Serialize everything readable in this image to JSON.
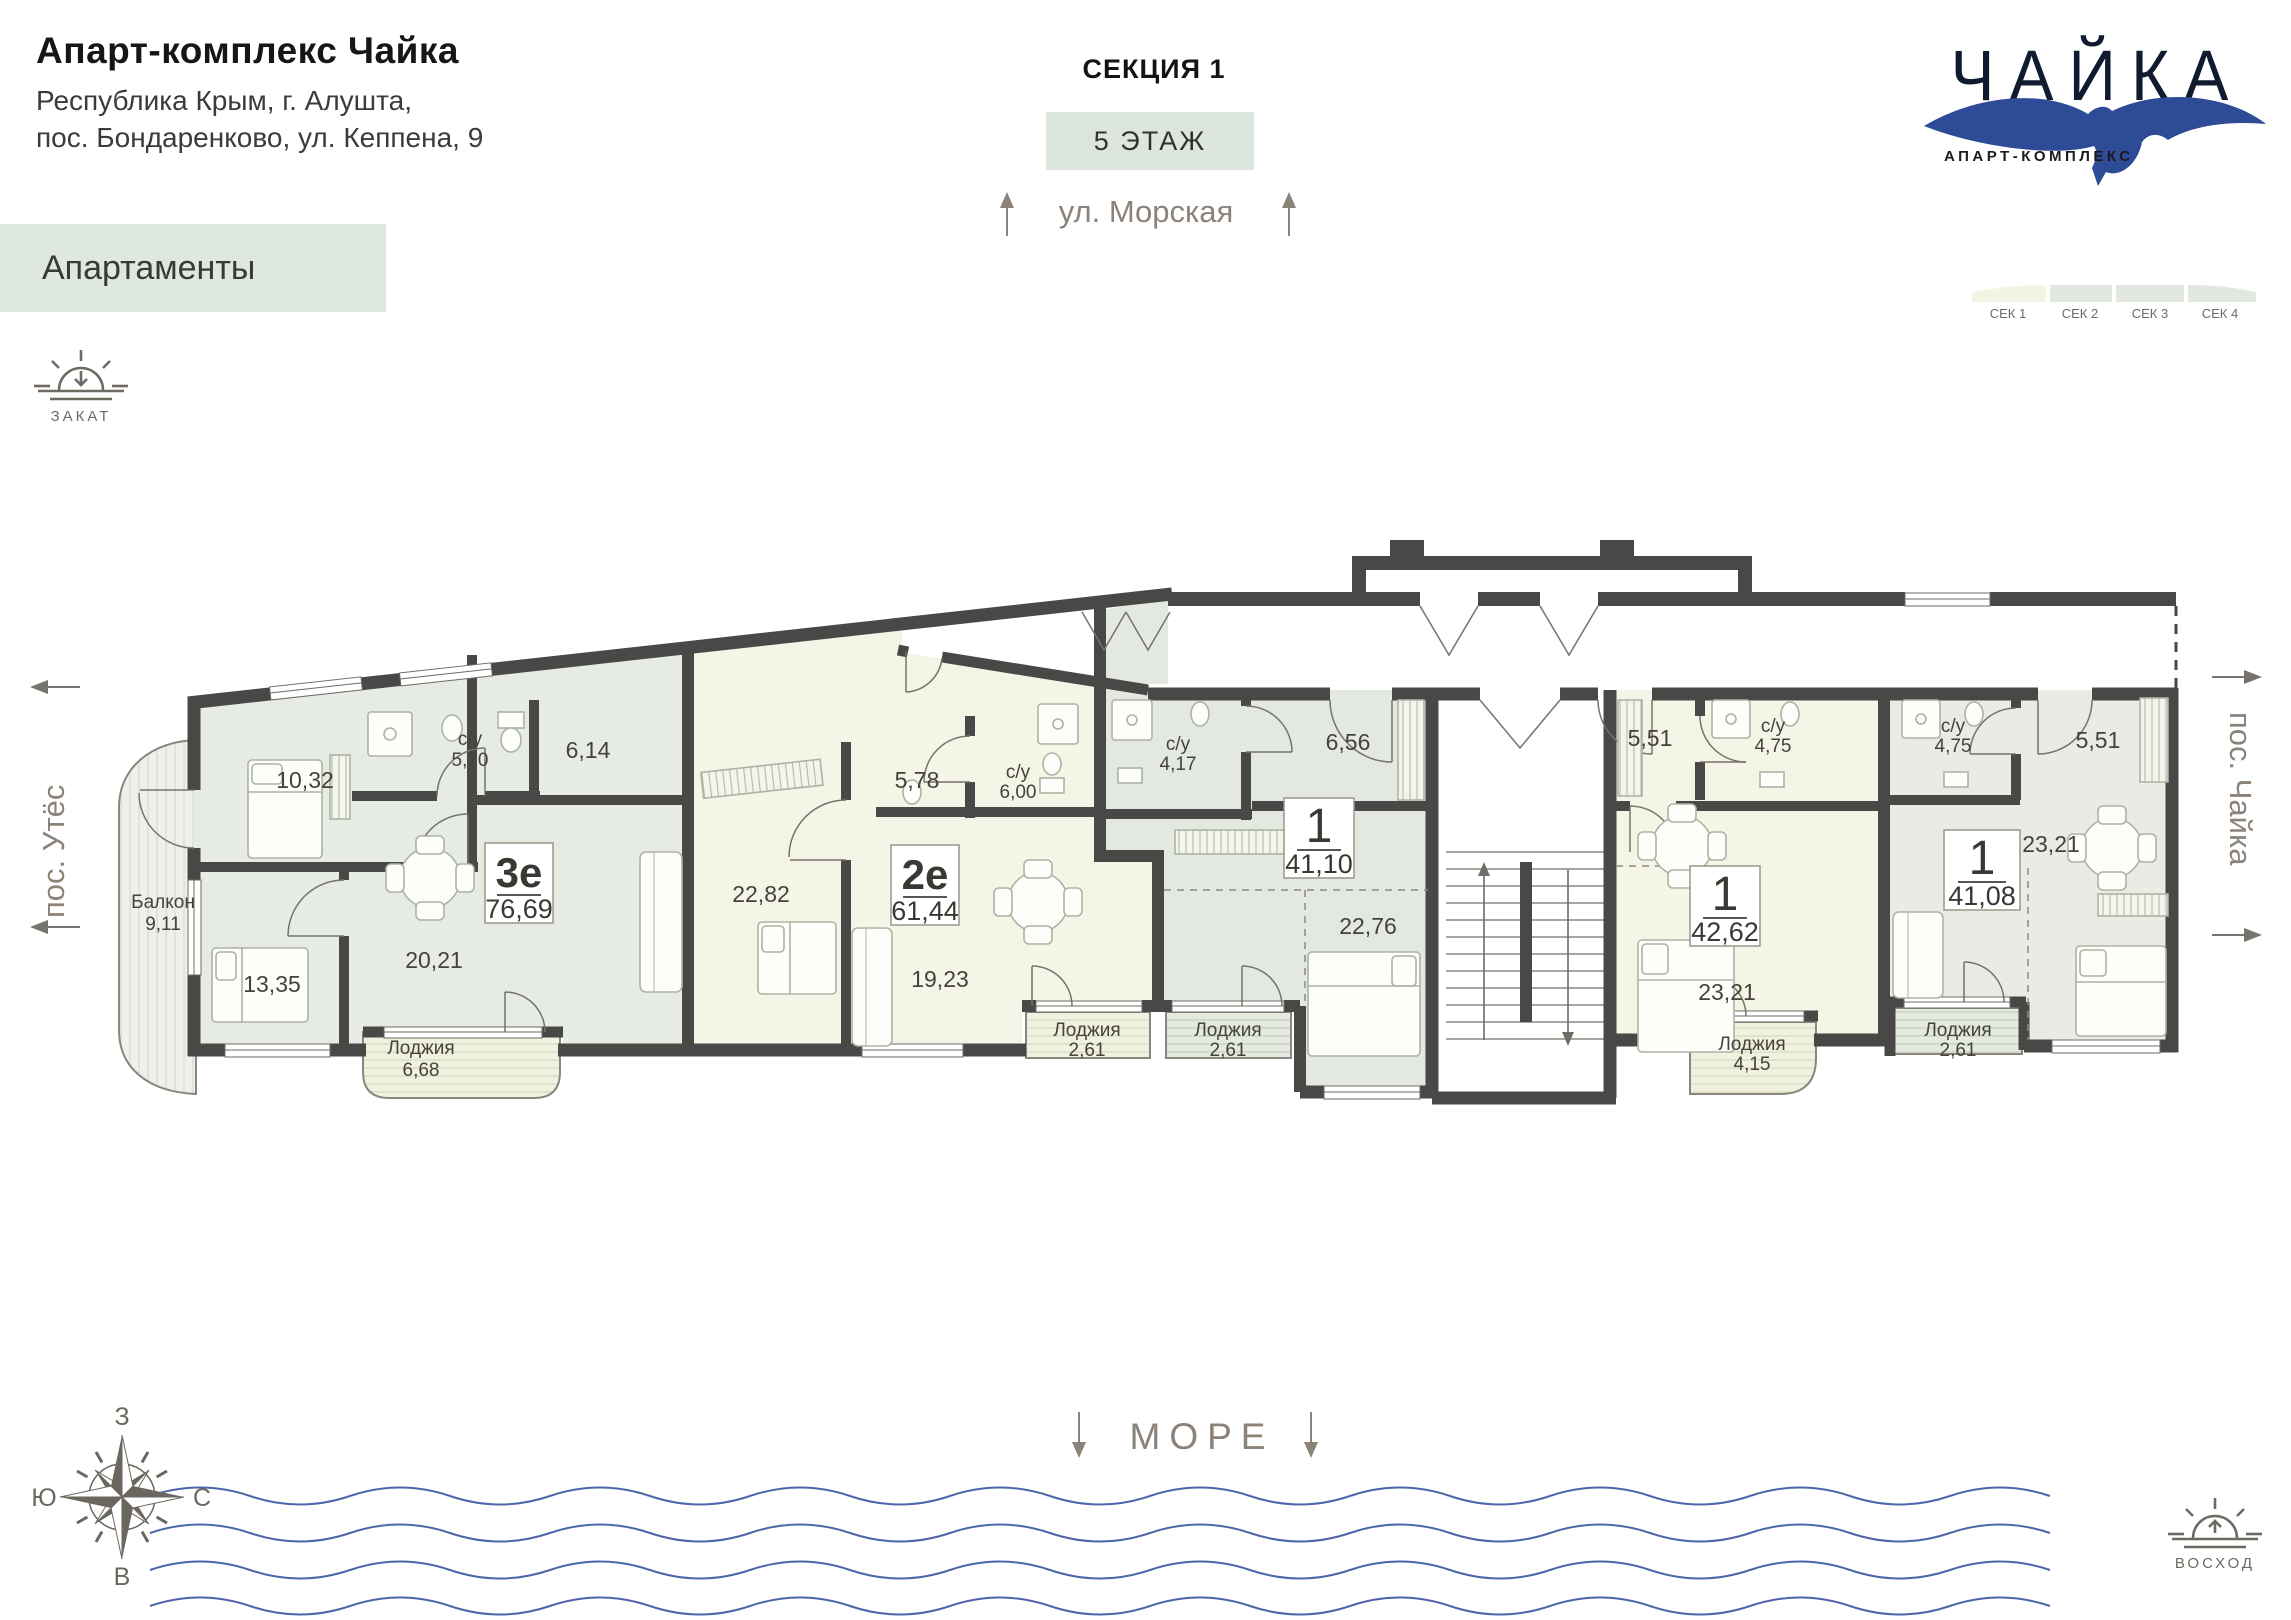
{
  "header": {
    "title": "Апарт-комплекс Чайка",
    "address_line1": "Республика Крым, г. Алушта,",
    "address_line2": "пос. Бондаренково, ул. Кеппена, 9",
    "category": "Апартаменты"
  },
  "plan_info": {
    "section": "СЕКЦИЯ 1",
    "floor": "5 ЭТАЖ"
  },
  "logo": {
    "title": "ЧАЙКА",
    "subtitle": "АПАРТ-КОМПЛЕКС"
  },
  "section_nav": {
    "items": [
      {
        "label": "СЕК 1",
        "active": true
      },
      {
        "label": "СЕК 2",
        "active": false
      },
      {
        "label": "СЕК 3",
        "active": false
      },
      {
        "label": "СЕК 4",
        "active": false
      }
    ]
  },
  "directions": {
    "street": "ул. Морская",
    "left_settlement": "пос. Утёс",
    "right_settlement": "пос. Чайка",
    "sea": "МОРЕ",
    "sunset": "ЗАКАТ",
    "sunrise": "ВОСХОД",
    "compass": {
      "top": "З",
      "left": "Ю",
      "right": "С",
      "bottom": "В"
    }
  },
  "plan": {
    "units": [
      {
        "id": "unit-3e",
        "type": "3е",
        "area": "76,69",
        "rooms": [
          {
            "name": "Балкон",
            "area": "9,11"
          },
          {
            "area": "10,32"
          },
          {
            "name": "с/у",
            "area": "5,70"
          },
          {
            "area": "6,14"
          },
          {
            "area": "13,35"
          },
          {
            "area": "20,21"
          },
          {
            "name": "Лоджия",
            "area": "6,68"
          }
        ]
      },
      {
        "id": "unit-2e",
        "type": "2е",
        "area": "61,44",
        "rooms": [
          {
            "area": "22,82"
          },
          {
            "area": "5,78"
          },
          {
            "name": "с/у",
            "area": "6,00"
          },
          {
            "area": "19,23"
          },
          {
            "name": "Лоджия",
            "area": "2,61"
          }
        ]
      },
      {
        "id": "unit-1a",
        "type": "1",
        "area": "41,10",
        "rooms": [
          {
            "name": "с/у",
            "area": "4,17"
          },
          {
            "area": "6,56"
          },
          {
            "area": "22,76"
          },
          {
            "name": "Лоджия",
            "area": "2,61"
          }
        ]
      },
      {
        "id": "unit-1b",
        "type": "1",
        "area": "42,62",
        "rooms": [
          {
            "area": "5,51"
          },
          {
            "name": "с/у",
            "area": "4,75"
          },
          {
            "area": "23,21"
          },
          {
            "name": "Лоджия",
            "area": "4,15"
          }
        ]
      },
      {
        "id": "unit-1c",
        "type": "1",
        "area": "41,08",
        "rooms": [
          {
            "name": "с/у",
            "area": "4,75"
          },
          {
            "area": "5,51"
          },
          {
            "area": "23,21"
          },
          {
            "name": "Лоджия",
            "area": "2,61"
          }
        ]
      }
    ]
  }
}
